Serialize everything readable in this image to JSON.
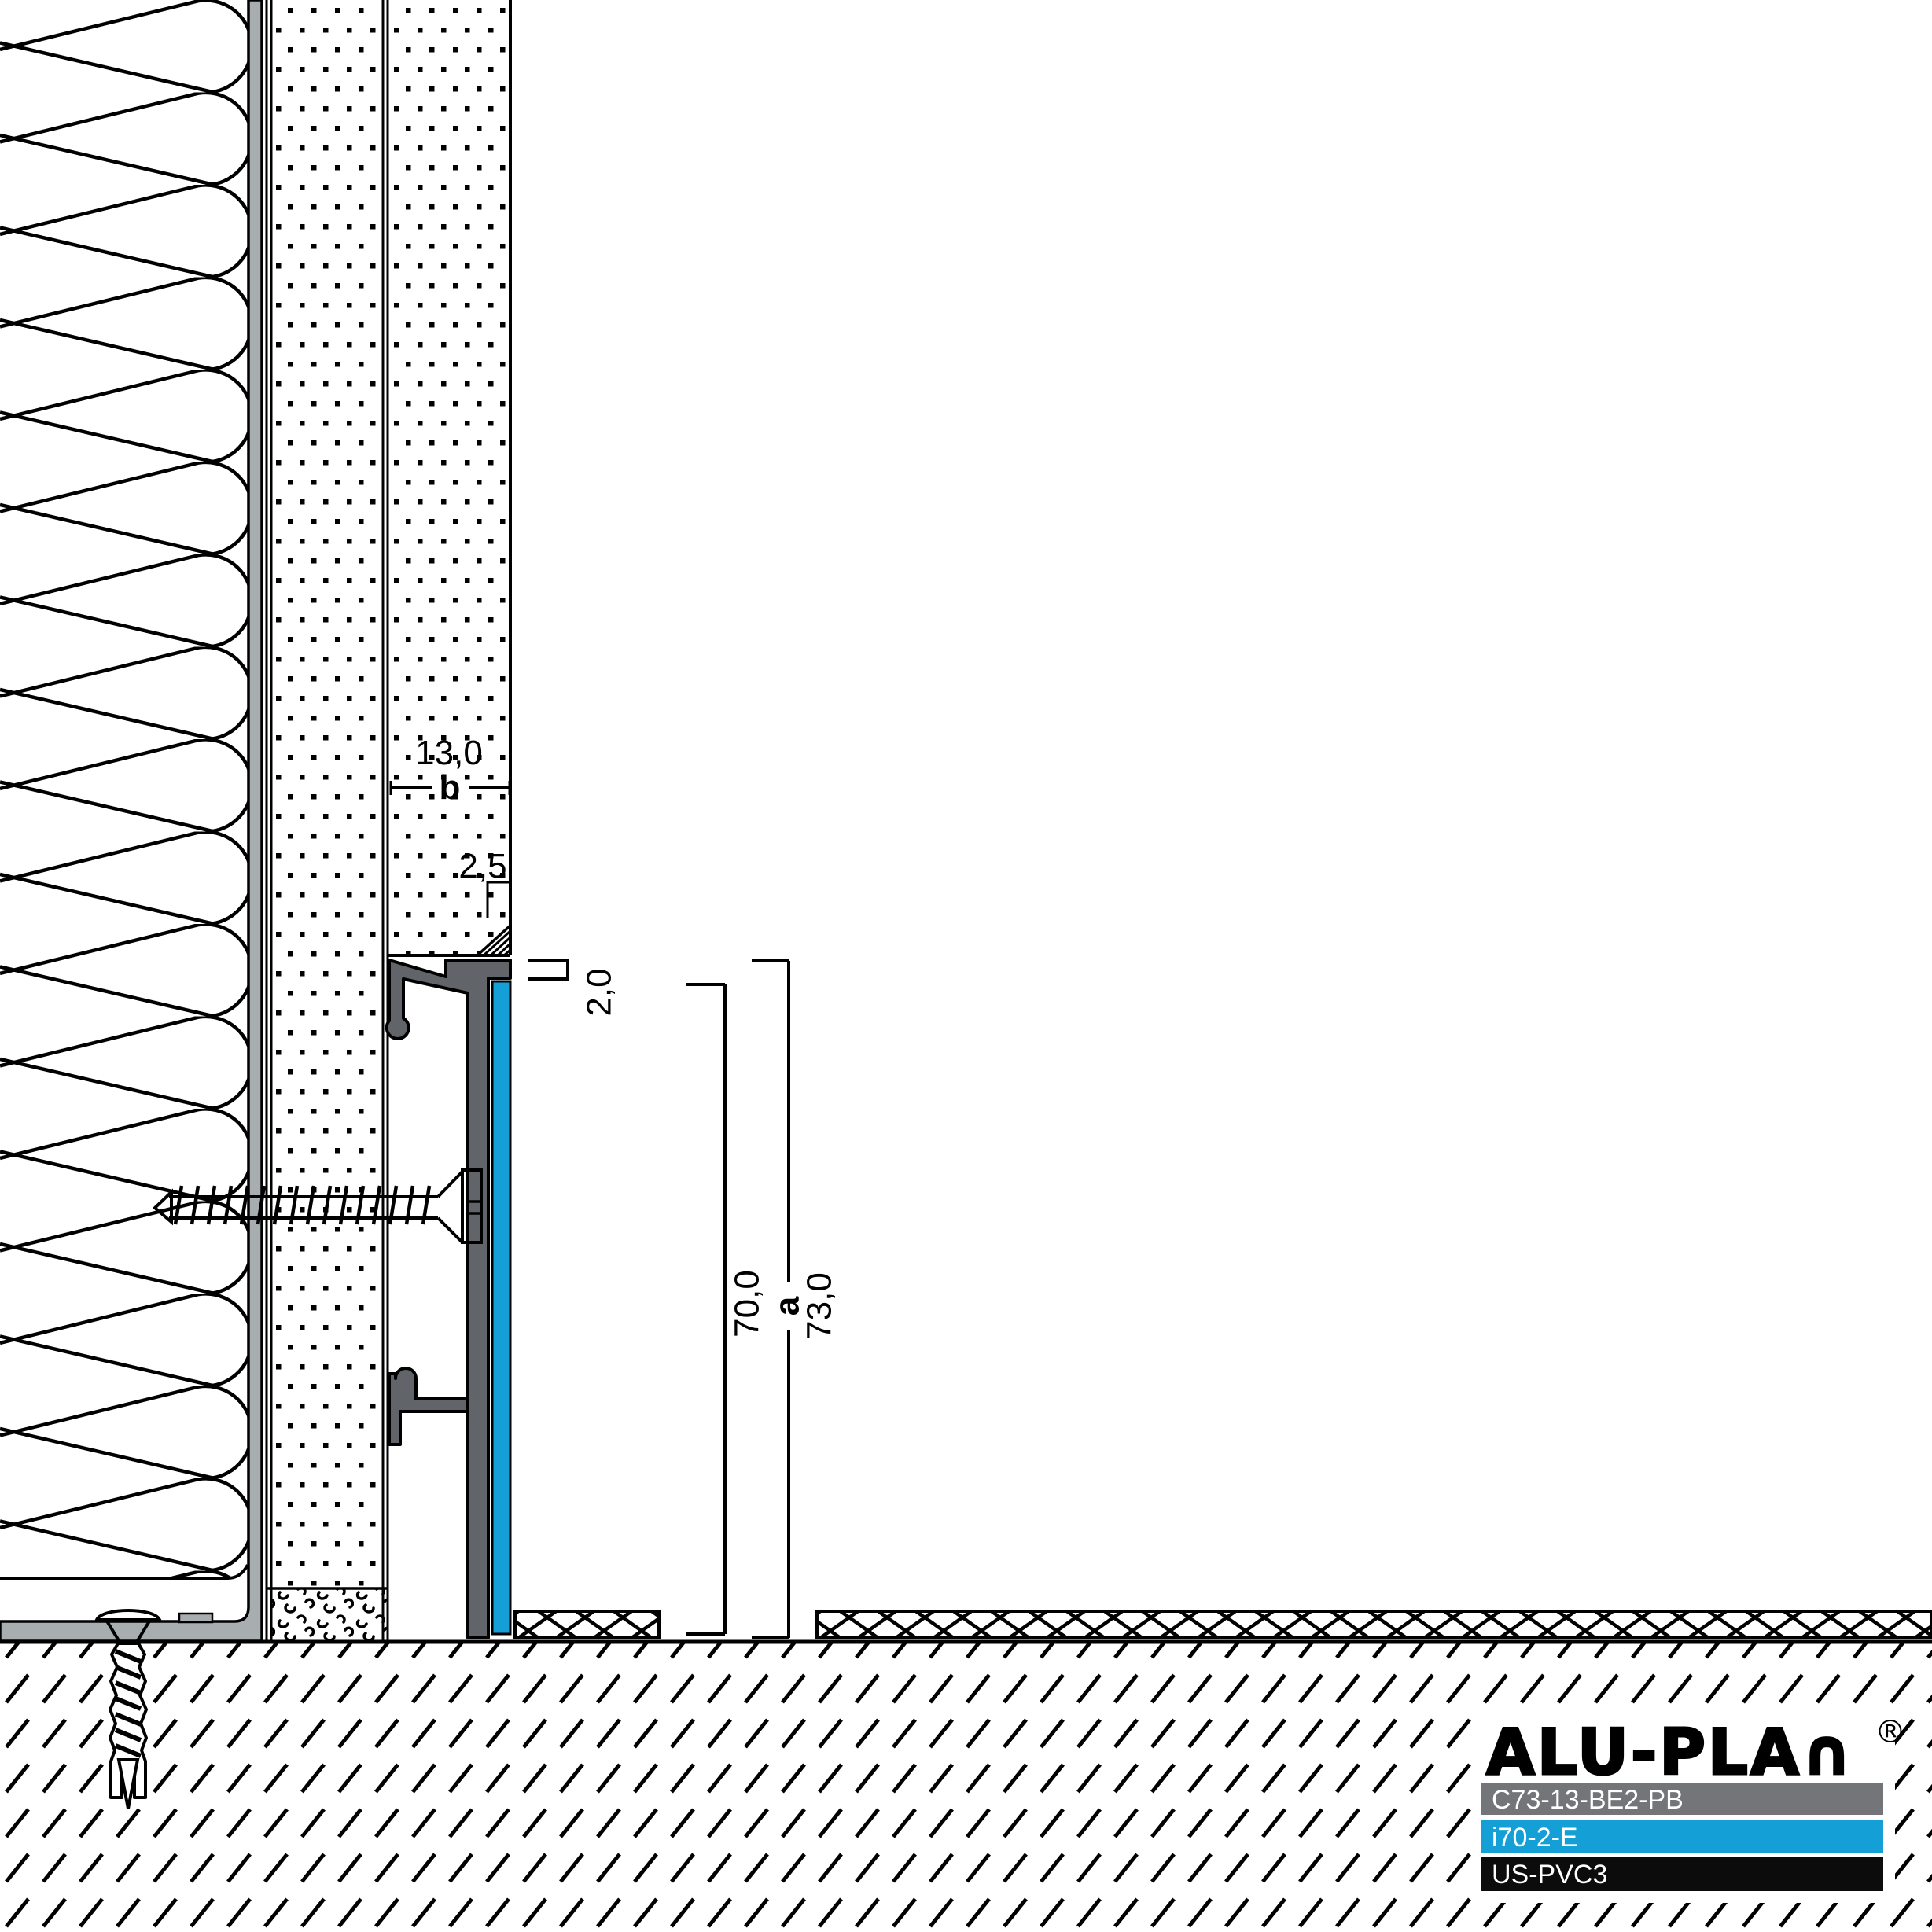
{
  "dims": {
    "plaster_width": "13,0",
    "plaster_width_var": "b",
    "joint_width": "2,5",
    "top_edge": "2,0",
    "profile_height": "70,0",
    "height_var": "a",
    "total_height": "73,0"
  },
  "legend": {
    "brand": "ALU-PLAN",
    "brand_display": "ALU-PLA∩",
    "registered": "®",
    "items": [
      {
        "code": "C73-13-BE2-PB",
        "color": "#747578",
        "text_color": "#ffffff"
      },
      {
        "code": "i70-2-E",
        "color": "#149fd6",
        "text_color": "#ffffff"
      },
      {
        "code": "US-PVC3",
        "color": "#0c0c0d",
        "text_color": "#ffffff"
      }
    ]
  },
  "colors": {
    "profile_gray": "#616468",
    "insert_blue": "#149fd6",
    "pvc_angle_gray": "#a8adb0",
    "line_black": "#000000"
  }
}
